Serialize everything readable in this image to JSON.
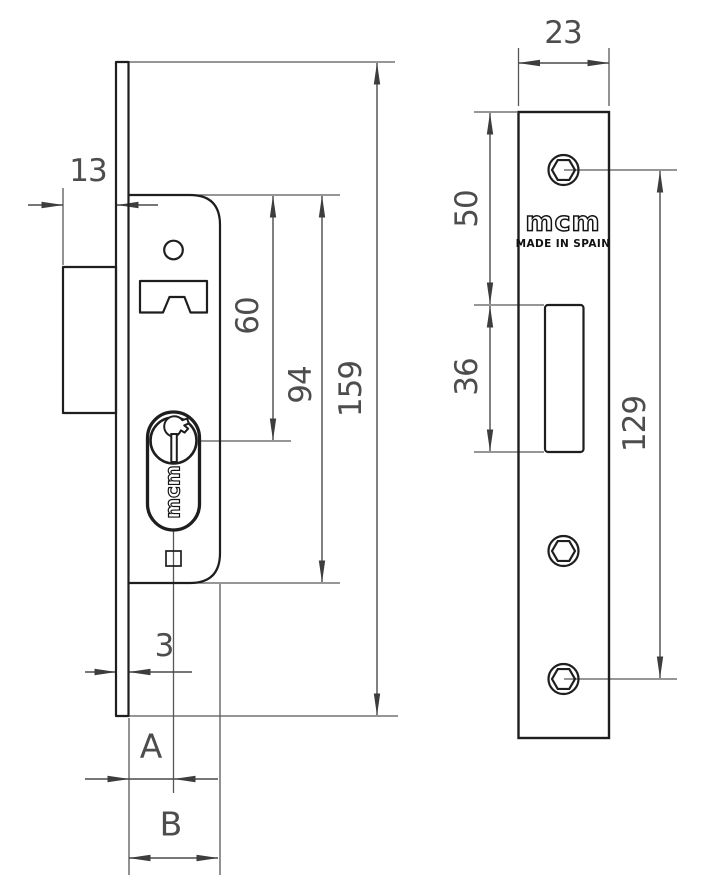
{
  "side_view": {
    "dim_bolt_protrusion": "13",
    "dim_top_to_cylinder": "60",
    "dim_case_length": "94",
    "dim_faceplate_length": "159",
    "dim_faceplate_thickness": "3",
    "dim_backset": "A",
    "dim_case_depth": "B",
    "cylinder_brand": "mcm"
  },
  "front_view": {
    "dim_faceplate_width": "23",
    "dim_top_to_cutout": "50",
    "dim_cutout_length": "36",
    "dim_screw_spacing": "129",
    "brand": "mcm",
    "origin": "MADE IN SPAIN"
  }
}
